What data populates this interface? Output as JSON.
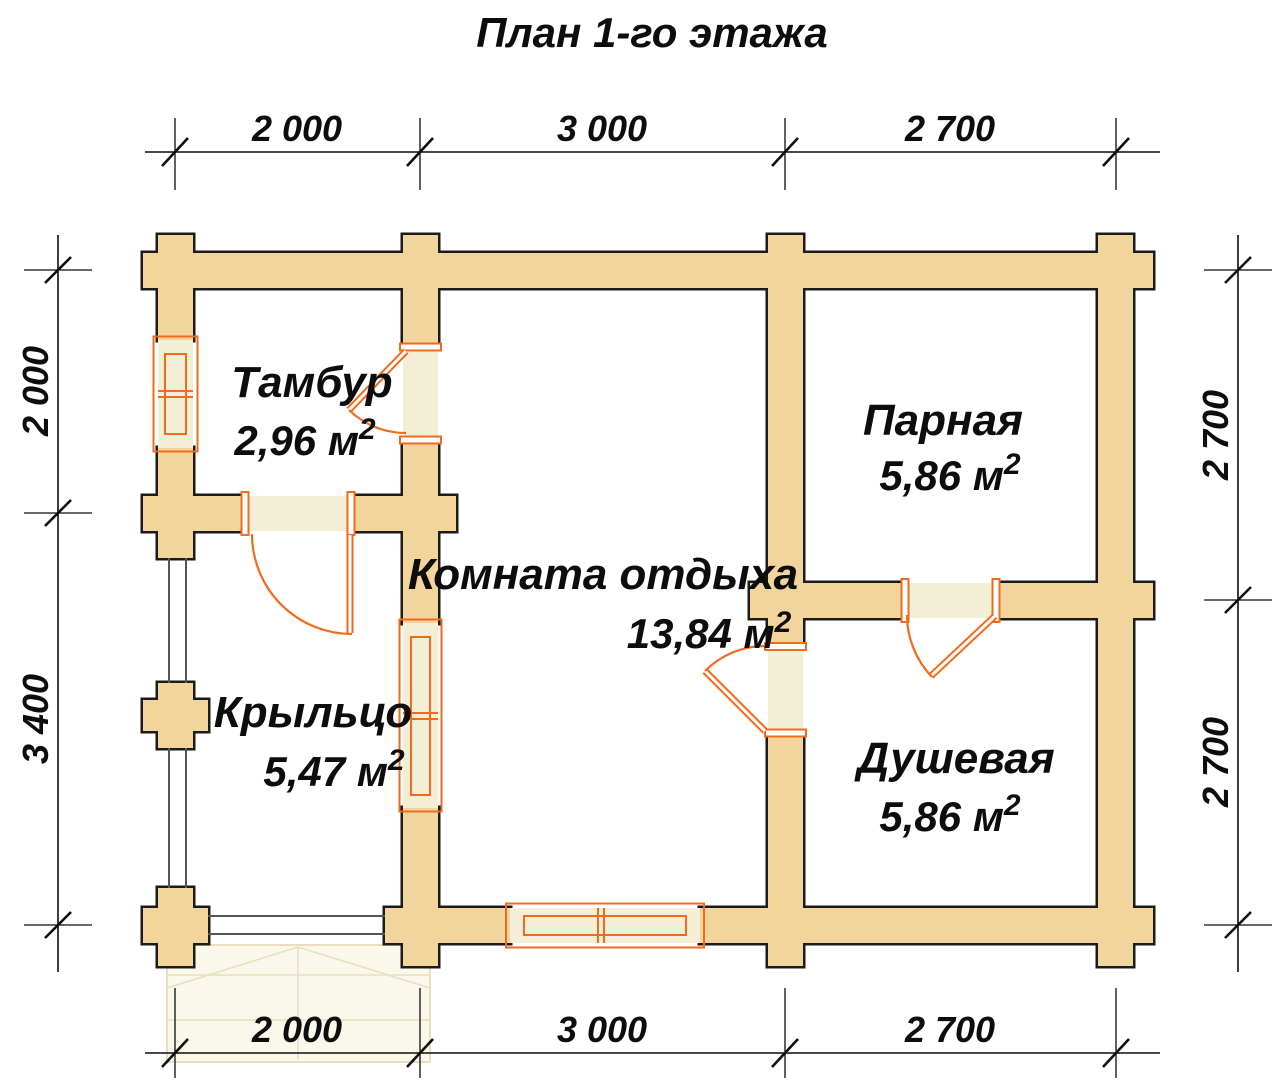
{
  "title": "План 1-го этажа",
  "rooms": [
    {
      "name": "Тамбур",
      "area_label": "2,96 м",
      "area_sup": "2"
    },
    {
      "name": "Парная",
      "area_label": "5,86 м",
      "area_sup": "2"
    },
    {
      "name": "Комната отдыха",
      "area_label": "13,84 м",
      "area_sup": "2"
    },
    {
      "name": "Крыльцо",
      "area_label": "5,47 м",
      "area_sup": "2"
    },
    {
      "name": "Душевая",
      "area_label": "5,86 м",
      "area_sup": "2"
    }
  ],
  "dimensions": {
    "top": [
      "2 000",
      "3 000",
      "2 700"
    ],
    "bottom": [
      "2 000",
      "3 000",
      "2 700"
    ],
    "left": [
      "2 000",
      "3 400"
    ],
    "right": [
      "2 700",
      "2 700"
    ]
  },
  "colors": {
    "wall": "#f1d59d",
    "wall_outline": "#1b1b1b",
    "opening": "#f2efd6",
    "frame": "#f26a1c",
    "railing": "#555555",
    "steps_fill": "#faf8eb",
    "steps_line": "#e7dfbe",
    "ink": "#0d0d0d"
  }
}
